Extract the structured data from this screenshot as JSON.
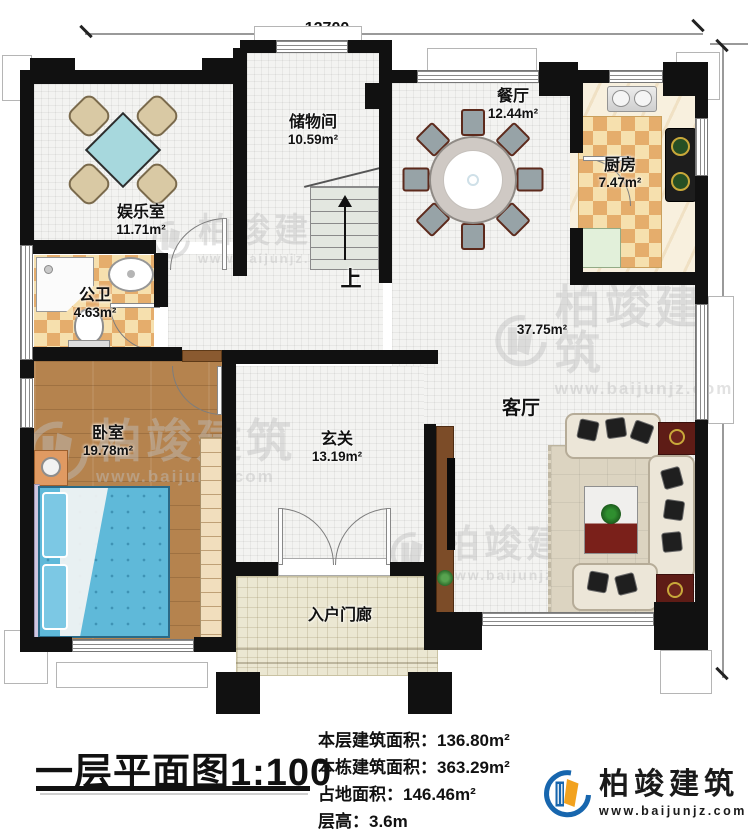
{
  "dimensions": {
    "top": "12700",
    "right": "11900"
  },
  "rooms": {
    "entertainment": {
      "name": "娱乐室",
      "area": "11.71m²"
    },
    "storage": {
      "name": "储物间",
      "area": "10.59m²"
    },
    "dining": {
      "name": "餐厅",
      "area": "12.44m²"
    },
    "kitchen": {
      "name": "厨房",
      "area": "7.47m²"
    },
    "bathroom": {
      "name": "公卫",
      "area": "4.63m²"
    },
    "bedroom": {
      "name": "卧室",
      "area": "19.78m²"
    },
    "hall": {
      "name": "玄关",
      "area": "13.19m²"
    },
    "living": {
      "name": "客厅",
      "area": "37.75m²"
    },
    "porch": {
      "name": "入户门廊"
    }
  },
  "stairs": {
    "label": "上"
  },
  "watermark": {
    "brand": "柏竣建筑",
    "site": "www.baijunjz.com"
  },
  "footer": {
    "title": "一层平面图1:100",
    "stats": [
      {
        "label": "本层建筑面积：",
        "value": "136.80m²"
      },
      {
        "label": "本栋建筑面积：",
        "value": "363.29m²"
      },
      {
        "label": "占地面积：",
        "value": "146.46m²"
      },
      {
        "label": "层高：",
        "value": "3.6m"
      }
    ],
    "logo": {
      "brand": "柏竣建筑",
      "site": "www.baijunjz.com"
    }
  },
  "colors": {
    "wall": "#111111",
    "logo_blue": "#1766ae",
    "logo_orange": "#f2a21f",
    "bed": "#5fb9d9",
    "checker": "#e5ad6c"
  }
}
